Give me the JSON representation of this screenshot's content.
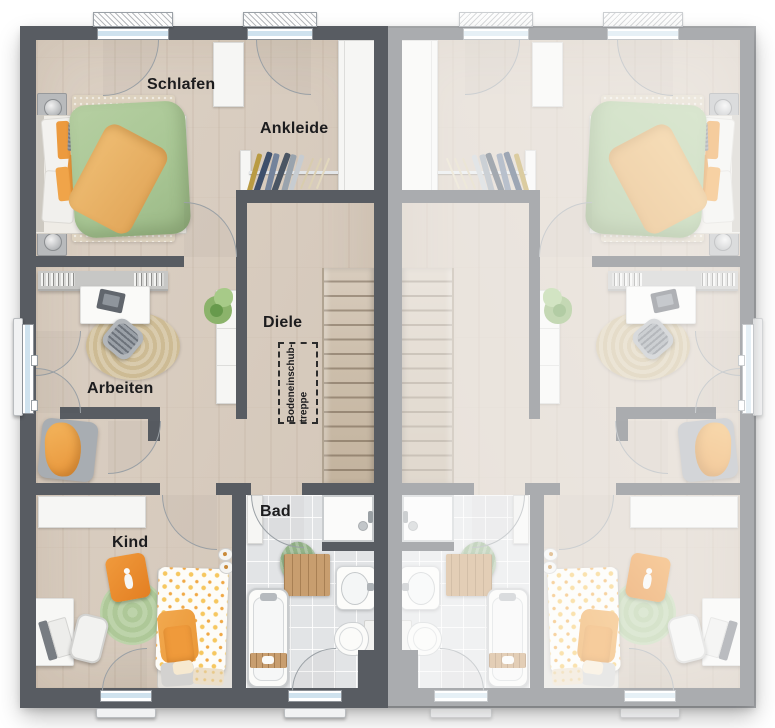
{
  "plan": {
    "type": "floor-plan",
    "description": "Upper-floor plan of a semi-detached duplex; left unit labeled, right unit mirrored and faded",
    "units": 2
  },
  "rooms": {
    "schlafen": "Schlafen",
    "ankleide": "Ankleide",
    "diele": "Diele",
    "arbeiten": "Arbeiten",
    "kind": "Kind",
    "bad": "Bad"
  },
  "annotations": {
    "attic_stairs_line1": "Bodeneinschub-",
    "attic_stairs_line2": "treppe"
  },
  "colors": {
    "wall_dark": "#585c62",
    "floor_wood": "#d8ccbf",
    "bath_tile": "#e2e4e6",
    "duvet_green": "#a9c795",
    "accent_orange": "#ec9a3e",
    "rug_green": "#b7cfa5",
    "background": "#ffffff",
    "mirrored_unit_opacity": "0.5"
  }
}
